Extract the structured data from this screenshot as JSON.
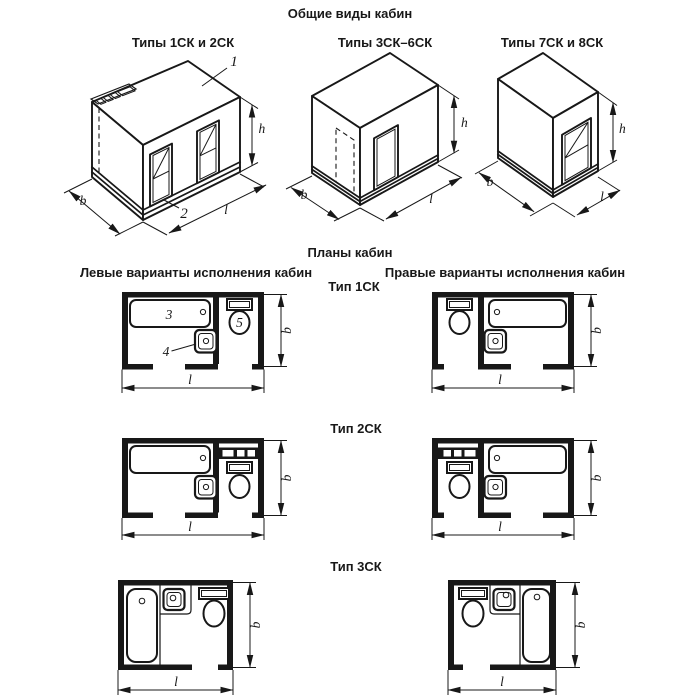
{
  "titles": {
    "general_views": "Общие виды кабин",
    "plans": "Планы кабин",
    "left_variants": "Левые варианты исполнения кабин",
    "right_variants": "Правые варианты исполнения кабин"
  },
  "view_labels": {
    "v1": "Типы 1СК и 2СК",
    "v2": "Типы 3СК–6СК",
    "v3": "Типы 7СК и 8СК"
  },
  "plan_labels": {
    "p1": "Тип 1СК",
    "p2": "Тип 2СК",
    "p3": "Тип 3СК"
  },
  "dims": {
    "h": "h",
    "b": "b",
    "l": "l"
  },
  "callouts": {
    "roof_panel": "1",
    "base_panel": "2",
    "bathtub": "3",
    "washbasin": "4",
    "toilet": "5"
  },
  "colors": {
    "background": "#ffffff",
    "line": "#181818"
  }
}
